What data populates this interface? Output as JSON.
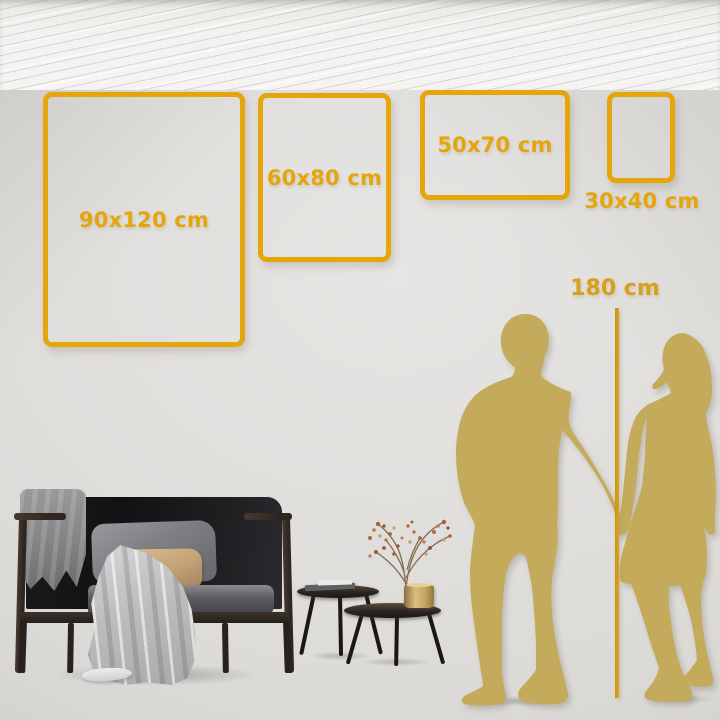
{
  "size_guide": {
    "frames": [
      {
        "id": "frame-90x120",
        "label": "90x120 cm"
      },
      {
        "id": "frame-60x80",
        "label": "60x80 cm"
      },
      {
        "id": "frame-50x70",
        "label": "50x70 cm"
      },
      {
        "id": "frame-30x40",
        "label": "30x40 cm"
      }
    ],
    "height_reference": {
      "label": "180 cm"
    }
  },
  "colors": {
    "accent_gold": "#E4A60C",
    "measure_gold": "#D8A018",
    "silhouette_gold": "#C4AB5B",
    "wall_grey": "#DEDCD9",
    "floor_white": "#F3F2F0",
    "sofa_black": "#1B1B1D",
    "pillow_tan": "#C5A277"
  },
  "scene_objects": [
    "man-silhouette",
    "woman-silhouette",
    "height-measure-line",
    "sofa",
    "dark-throw-blanket",
    "light-throw-blanket",
    "grey-pillow",
    "tan-pillow",
    "nesting-coffee-tables",
    "books",
    "gold-vase",
    "dried-branch"
  ]
}
